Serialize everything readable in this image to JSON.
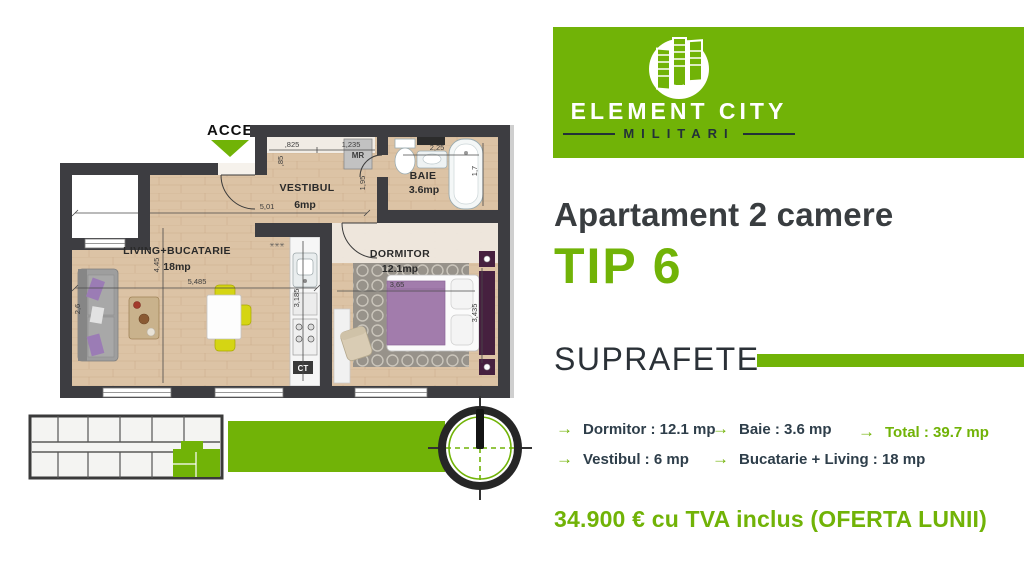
{
  "brand": {
    "name": "ELEMENT CITY",
    "location": "MILITARI"
  },
  "headline": {
    "title": "Apartament 2 camere",
    "type": "TIP 6"
  },
  "surfaces_section": {
    "heading": "SUPRAFETE",
    "items": [
      {
        "text": "Dormitor : 12.1 mp",
        "highlight": false
      },
      {
        "text": "Baie : 3.6 mp",
        "highlight": false
      },
      {
        "text": "Total : 39.7 mp",
        "highlight": true
      },
      {
        "text": "Vestibul : 6 mp",
        "highlight": false
      },
      {
        "text": "Bucatarie + Living : 18 mp",
        "highlight": false
      }
    ]
  },
  "price": "34.900 € cu TVA inclus (OFERTA LUNII)",
  "icons": {
    "arrow": "→",
    "radiator": "✳✳✳"
  },
  "floorplan": {
    "access_label": "ACCES",
    "rooms": {
      "living": {
        "name": "LIVING+BUCATARIE",
        "area": "18mp"
      },
      "vestibul": {
        "name": "VESTIBUL",
        "area": "6mp"
      },
      "baie": {
        "name": "BAIE",
        "area": "3.6mp"
      },
      "dormitor": {
        "name": "DORMITOR",
        "area": "12.1mp"
      }
    },
    "dims": {
      "hall_w": "5,01",
      "closet_w1": ",825",
      "closet_w2": "1,235",
      "closet_d": ",85",
      "hall_h": "1,95",
      "bath_w": "2,25",
      "tub_l": "1,7",
      "living_w": "5,485",
      "living_h": "4,45",
      "living_side": "2,6",
      "kitchen_h": "3,185",
      "bed_w": "3,65",
      "dorm_h": "3,435"
    },
    "labels": {
      "washer": "MR",
      "boiler": "CT"
    }
  },
  "colors": {
    "accent": "#71b307",
    "wall": "#3d3d41",
    "floor": "#dcc3a5",
    "dark_text": "#393d40",
    "list_text": "#2e3e4a"
  }
}
